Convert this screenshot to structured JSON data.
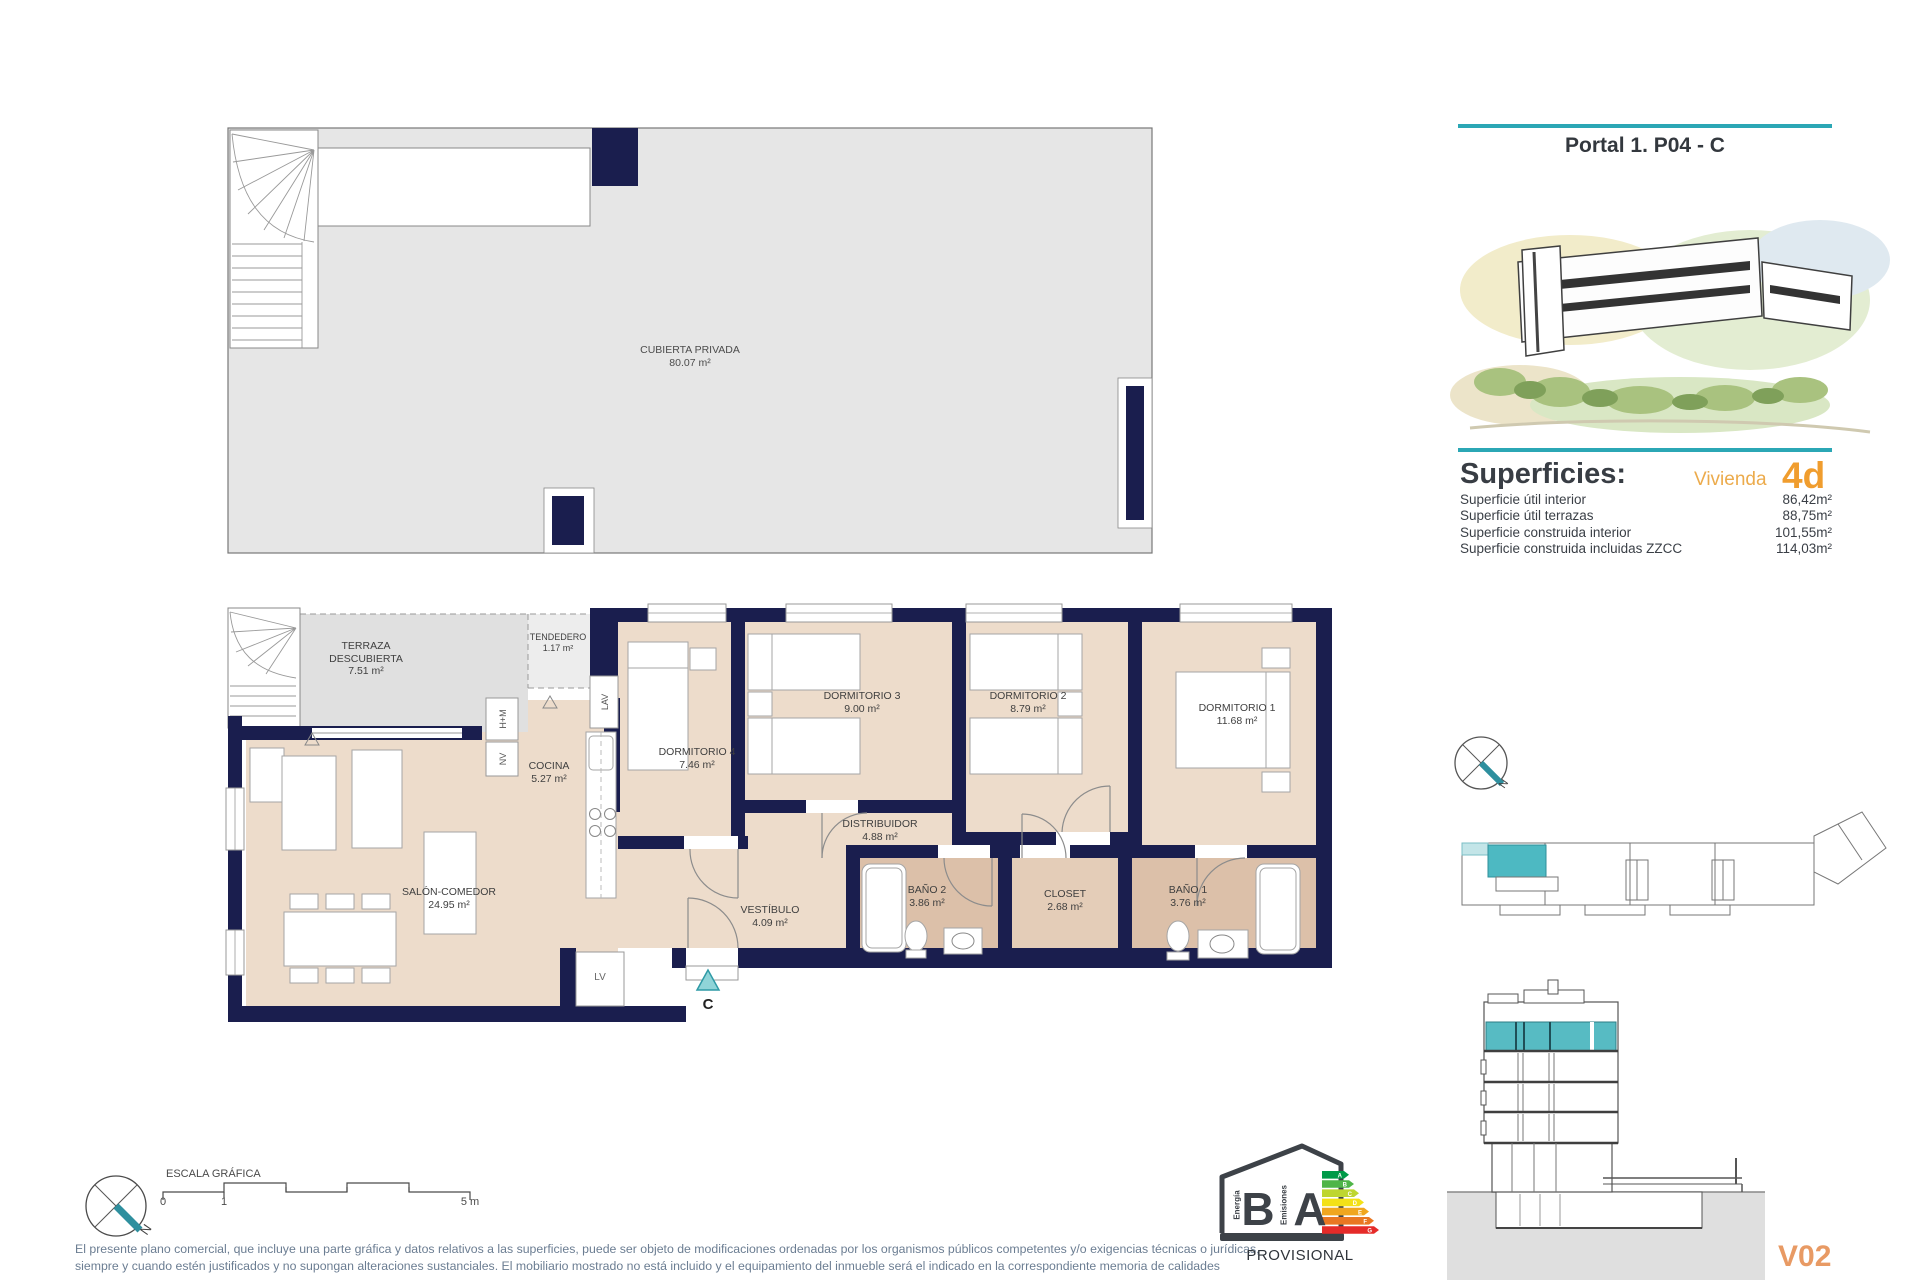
{
  "header": {
    "title": "Portal 1. P04 - C"
  },
  "superficies": {
    "heading": "Superficies:",
    "vivienda_label": "Vivienda",
    "vivienda_code": "4d",
    "rows": [
      {
        "label": "Superficie útil interior",
        "value": "86,42m²"
      },
      {
        "label": "Superficie útil terrazas",
        "value": "88,75m²"
      },
      {
        "label": "Superficie construida interior",
        "value": "101,55m²"
      },
      {
        "label": "Superficie construida incluidas ZZCC",
        "value": "114,03m²"
      }
    ]
  },
  "roof_plan": {
    "room": {
      "name": "CUBIERTA PRIVADA",
      "area": "80.07 m²"
    }
  },
  "floor_plan": {
    "rooms": [
      {
        "name": "TERRAZA\nDESCUBIERTA",
        "area": "7.51 m²"
      },
      {
        "name": "TENDEDERO",
        "area": "1.17 m²"
      },
      {
        "name": "COCINA",
        "area": "5.27 m²"
      },
      {
        "name": "DORMITORIO 4",
        "area": "7.46 m²"
      },
      {
        "name": "DORMITORIO 3",
        "area": "9.00 m²"
      },
      {
        "name": "DORMITORIO 2",
        "area": "8.79 m²"
      },
      {
        "name": "DORMITORIO 1",
        "area": "11.68 m²"
      },
      {
        "name": "DISTRIBUIDOR",
        "area": "4.88 m²"
      },
      {
        "name": "SALÓN-COMEDOR",
        "area": "24.95 m²"
      },
      {
        "name": "VESTÍBULO",
        "area": "4.09 m²"
      },
      {
        "name": "BAÑO 2",
        "area": "3.86 m²"
      },
      {
        "name": "CLOSET",
        "area": "2.68 m²"
      },
      {
        "name": "BAÑO 1",
        "area": "3.76 m²"
      }
    ],
    "closet_labels": {
      "hm": "H+M",
      "nv": "NV",
      "lav": "LAV",
      "lv": "LV"
    },
    "entrance_marker": "C"
  },
  "scale_bar": {
    "label": "ESCALA GRÁFICA",
    "tick_start": "0",
    "tick_one": "1",
    "tick_end": "5 m"
  },
  "compass": {
    "north_label": "N"
  },
  "disclaimer": {
    "line1": "El presente plano comercial, que incluye una parte gráfica y datos relativos a las superficies, puede ser objeto de modificaciones ordenadas por los organismos públicos competentes y/o exigencias técnicas o jurídicas,",
    "line2": "siempre y cuando estén justificados y no supongan alteraciones sustanciales. El mobiliario mostrado no está incluido y el equipamiento del inmueble será el indicado en la correspondiente memoria de calidades"
  },
  "energy_label": {
    "letter_energy": "B",
    "letter_emissions": "A",
    "energia": "Energía",
    "emisiones": "Emisiones",
    "status": "PROVISIONAL",
    "arrow_letters": [
      "A",
      "B",
      "C",
      "D",
      "E",
      "F",
      "G"
    ]
  },
  "version": "V02",
  "colors": {
    "accent_teal": "#2ba7b5",
    "highlight_teal": "#4db9c2",
    "orange": "#f09d2e",
    "navy_wall": "#1a1e4e",
    "floor_beige": "#eddccb",
    "bath_tan": "#dcc0a9",
    "terrace_gray": "#e0e0e0",
    "version_orange": "#e89a64"
  }
}
